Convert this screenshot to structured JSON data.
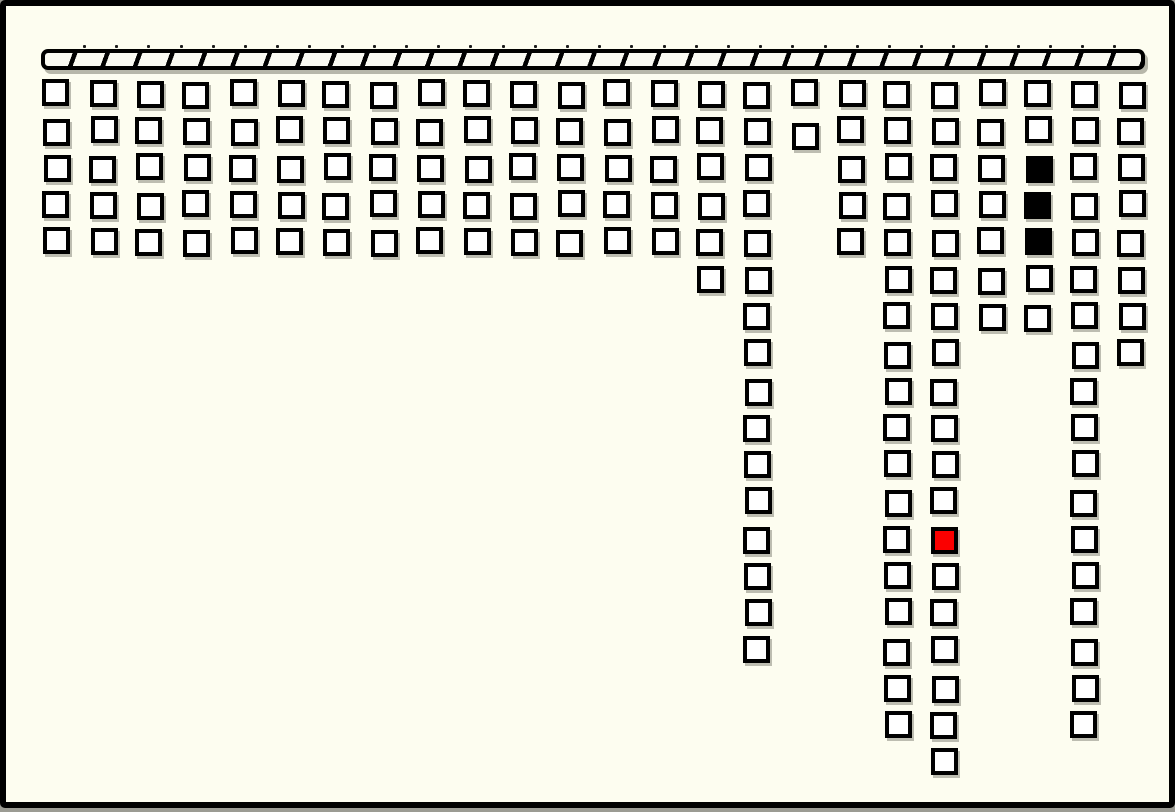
{
  "board": {
    "type": "block-grid-diagram",
    "colors": {
      "background": "#fdfdf0",
      "frame_border": "#000000",
      "cell_fill": "#ffffff",
      "cell_border": "#000000",
      "bar_fill": "#fafaf2",
      "hatch_stroke": "#000000",
      "mark_black": "#000000",
      "mark_red": "#fb0000",
      "shadow": "#7d7d71"
    },
    "bar": {
      "x": 35,
      "y": 43,
      "width": 1104,
      "height": 21,
      "hatch_period_px": 30.5,
      "hatch_stroke_px": 4.5,
      "hatch_angle_deg": 110,
      "tick_count": 33,
      "tick_start_x": 77,
      "tick_spacing": 32.2,
      "tick_y": 39
    },
    "grid": {
      "origin_x": 37,
      "origin_y": 74,
      "col_spacing": 46.74,
      "row_spacing": 37.1,
      "cell_size": 27,
      "num_columns": 24,
      "max_rows": 19
    },
    "columns": [
      {
        "length": 5
      },
      {
        "length": 5
      },
      {
        "length": 5
      },
      {
        "length": 5
      },
      {
        "length": 5
      },
      {
        "length": 5
      },
      {
        "length": 5
      },
      {
        "length": 5
      },
      {
        "length": 5
      },
      {
        "length": 5
      },
      {
        "length": 5
      },
      {
        "length": 5
      },
      {
        "length": 5
      },
      {
        "length": 5
      },
      {
        "length": 6
      },
      {
        "length": 16
      },
      {
        "length": 2,
        "offsets": [
          {
            "row": 1,
            "dy": 4
          }
        ]
      },
      {
        "length": 5
      },
      {
        "length": 18
      },
      {
        "length": 19,
        "marks": [
          {
            "row": 12,
            "color": "red"
          }
        ]
      },
      {
        "length": 7
      },
      {
        "length": 7,
        "marks": [
          {
            "row": 2,
            "color": "black"
          },
          {
            "row": 3,
            "color": "black"
          },
          {
            "row": 4,
            "color": "black"
          }
        ]
      },
      {
        "length": 18
      },
      {
        "length": 8
      }
    ]
  }
}
